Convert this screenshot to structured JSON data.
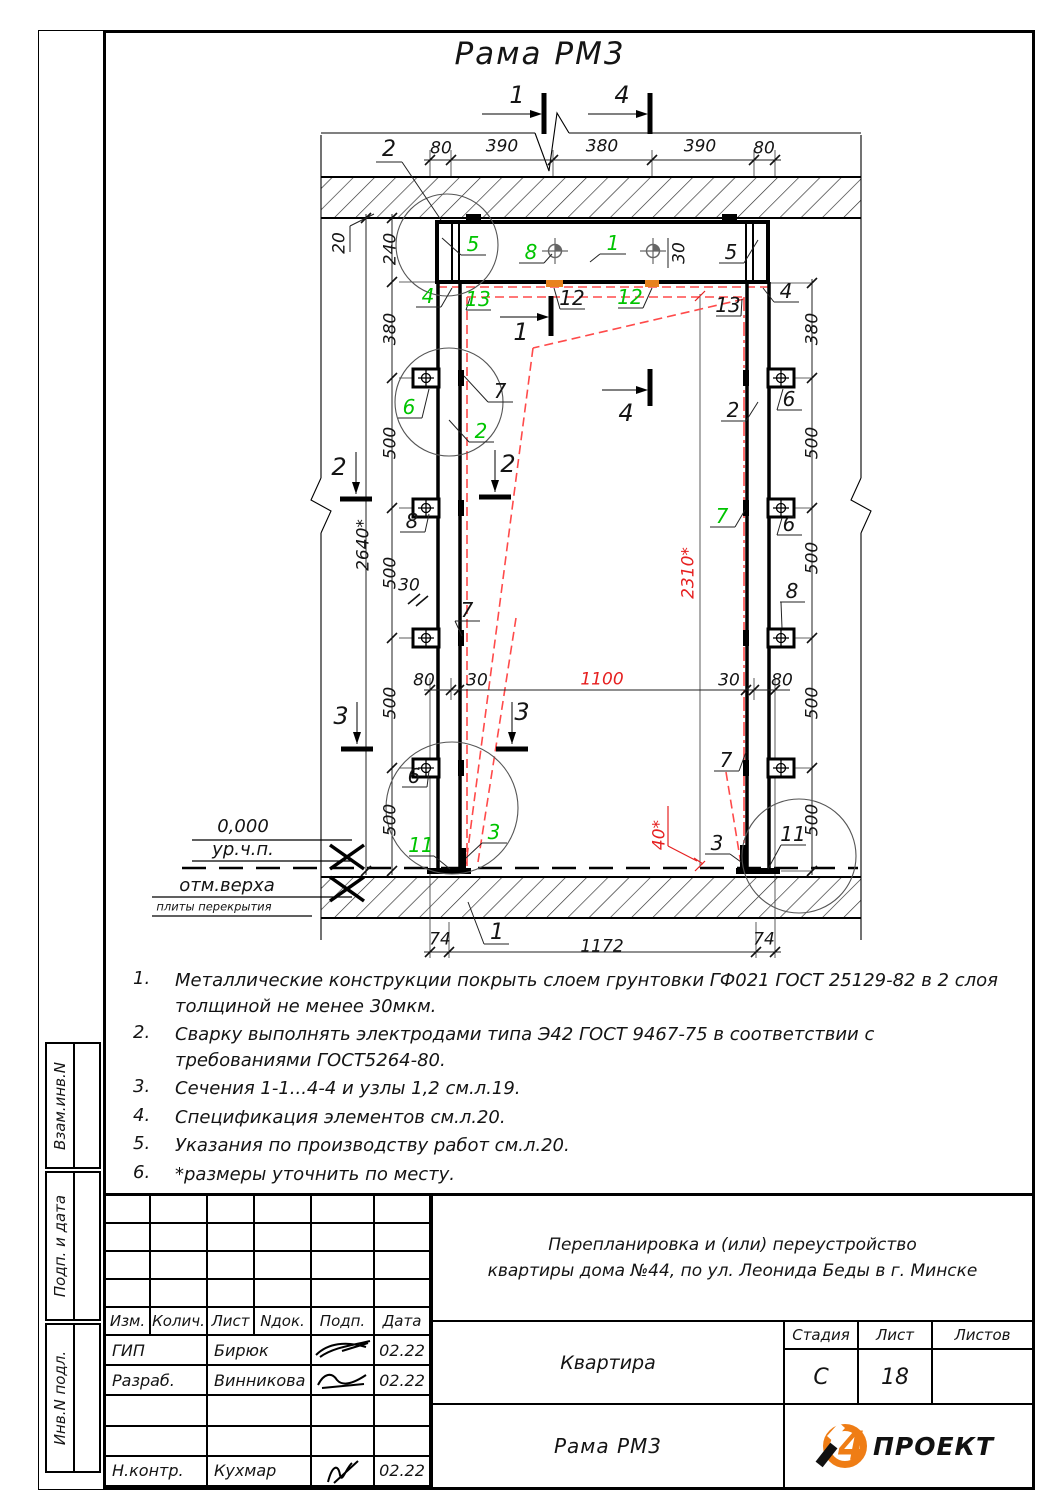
{
  "page": {
    "title": "Рама РМ3"
  },
  "colors": {
    "green": "#00c400",
    "red": "#e62020",
    "red_line": "#ff4a4a",
    "orange": "#e8821e"
  },
  "drawing": {
    "labels": [
      {
        "n": "dim-top-80-left",
        "t": "80",
        "x": 441,
        "y": 149
      },
      {
        "n": "dim-top-390-left",
        "t": "390",
        "x": 502,
        "y": 147
      },
      {
        "n": "dim-top-380",
        "t": "380",
        "x": 602,
        "y": 147
      },
      {
        "n": "dim-top-390-right",
        "t": "390",
        "x": 700,
        "y": 147
      },
      {
        "n": "dim-top-80-right",
        "t": "80",
        "x": 764,
        "y": 149
      },
      {
        "n": "dim-240-left",
        "t": "240",
        "x": 391,
        "y": 249,
        "r": -90
      },
      {
        "n": "dim-20-left",
        "t": "20",
        "x": 340,
        "y": 243,
        "r": -90
      },
      {
        "n": "dim-380-left",
        "t": "380",
        "x": 391,
        "y": 329,
        "r": -90
      },
      {
        "n": "dim-500-left-1",
        "t": "500",
        "x": 391,
        "y": 443,
        "r": -90
      },
      {
        "n": "dim-500-left-2",
        "t": "500",
        "x": 391,
        "y": 573,
        "r": -90
      },
      {
        "n": "dim-500-left-3",
        "t": "500",
        "x": 391,
        "y": 703,
        "r": -90
      },
      {
        "n": "dim-500-left-4",
        "t": "500",
        "x": 391,
        "y": 820,
        "r": -90
      },
      {
        "n": "dim-2640-left",
        "t": "2640*",
        "x": 364,
        "y": 545,
        "r": -90
      },
      {
        "n": "dim-380-right",
        "t": "380",
        "x": 813,
        "y": 329,
        "r": -90
      },
      {
        "n": "dim-500-right-1",
        "t": "500",
        "x": 813,
        "y": 443,
        "r": -90
      },
      {
        "n": "dim-500-right-2",
        "t": "500",
        "x": 813,
        "y": 558,
        "r": -90
      },
      {
        "n": "dim-500-right-3",
        "t": "500",
        "x": 813,
        "y": 703,
        "r": -90
      },
      {
        "n": "dim-500-right-4",
        "t": "500",
        "x": 813,
        "y": 820,
        "r": -90
      },
      {
        "n": "dim-2310-red",
        "t": "2310*",
        "x": 689,
        "y": 573,
        "r": -90,
        "c": "r"
      },
      {
        "n": "dim-40-red",
        "t": "40*",
        "x": 660,
        "y": 835,
        "r": -90,
        "c": "r"
      },
      {
        "n": "dim-1100-red",
        "t": "1100",
        "x": 602,
        "y": 680,
        "c": "r"
      },
      {
        "n": "dim-mid-80-left",
        "t": "80",
        "x": 424,
        "y": 681
      },
      {
        "n": "dim-mid-30-left",
        "t": "30",
        "x": 477,
        "y": 681
      },
      {
        "n": "dim-mid-30-right",
        "t": "30",
        "x": 729,
        "y": 681
      },
      {
        "n": "dim-mid-80-right",
        "t": "80",
        "x": 782,
        "y": 681
      },
      {
        "n": "dim-30-column",
        "t": "30",
        "x": 409,
        "y": 586
      },
      {
        "n": "dim-30-beam",
        "t": "30",
        "x": 680,
        "y": 253,
        "r": -90
      },
      {
        "n": "dim-74-left",
        "t": "74",
        "x": 440,
        "y": 940
      },
      {
        "n": "dim-1172-bottom",
        "t": "1172",
        "x": 602,
        "y": 947
      },
      {
        "n": "dim-74-right",
        "t": "74",
        "x": 764,
        "y": 940
      },
      {
        "n": "section-1-top",
        "t": "1",
        "x": 517,
        "y": 95,
        "s": 24
      },
      {
        "n": "section-4-top",
        "t": "4",
        "x": 622,
        "y": 95,
        "s": 24
      },
      {
        "n": "section-1-mid",
        "t": "1",
        "x": 521,
        "y": 332,
        "s": 24
      },
      {
        "n": "section-4-mid",
        "t": "4",
        "x": 626,
        "y": 413,
        "s": 24
      },
      {
        "n": "section-2-left",
        "t": "2",
        "x": 339,
        "y": 467,
        "s": 24
      },
      {
        "n": "section-2-mid",
        "t": "2",
        "x": 508,
        "y": 464,
        "s": 24
      },
      {
        "n": "section-3-left",
        "t": "3",
        "x": 341,
        "y": 716,
        "s": 24
      },
      {
        "n": "section-3-mid",
        "t": "3",
        "x": 522,
        "y": 712,
        "s": 24
      },
      {
        "n": "callout-2-top",
        "t": "2",
        "x": 389,
        "y": 150,
        "s": 22
      },
      {
        "n": "callout-5-left",
        "t": "5",
        "x": 473,
        "y": 244,
        "c": "g",
        "s": 20
      },
      {
        "n": "callout-8-bolt",
        "t": "8",
        "x": 531,
        "y": 252,
        "c": "g",
        "s": 20
      },
      {
        "n": "callout-1-beam",
        "t": "1",
        "x": 613,
        "y": 243,
        "c": "g",
        "s": 20
      },
      {
        "n": "callout-5-right",
        "t": "5",
        "x": 731,
        "y": 252,
        "s": 20
      },
      {
        "n": "callout-4-left",
        "t": "4",
        "x": 428,
        "y": 296,
        "c": "g",
        "s": 20
      },
      {
        "n": "callout-13-left",
        "t": "13",
        "x": 478,
        "y": 299,
        "c": "g",
        "s": 20
      },
      {
        "n": "callout-12-left",
        "t": "12",
        "x": 572,
        "y": 298,
        "s": 20
      },
      {
        "n": "callout-12-right",
        "t": "12",
        "x": 630,
        "y": 297,
        "c": "g",
        "s": 20
      },
      {
        "n": "callout-13-right",
        "t": "13",
        "x": 728,
        "y": 305,
        "s": 20
      },
      {
        "n": "callout-4-right",
        "t": "4",
        "x": 786,
        "y": 291,
        "s": 20
      },
      {
        "n": "callout-6-left-1",
        "t": "6",
        "x": 409,
        "y": 407,
        "c": "g",
        "s": 20
      },
      {
        "n": "callout-7-left-1",
        "t": "7",
        "x": 500,
        "y": 391,
        "s": 20
      },
      {
        "n": "callout-2-column",
        "t": "2",
        "x": 481,
        "y": 431,
        "c": "g",
        "s": 20
      },
      {
        "n": "callout-2-right",
        "t": "2",
        "x": 733,
        "y": 410,
        "s": 20
      },
      {
        "n": "callout-6-right-1",
        "t": "6",
        "x": 789,
        "y": 399,
        "s": 20
      },
      {
        "n": "callout-7-right",
        "t": "7",
        "x": 722,
        "y": 516,
        "c": "g",
        "s": 20
      },
      {
        "n": "callout-6-right-2",
        "t": "6",
        "x": 789,
        "y": 524,
        "s": 20
      },
      {
        "n": "callout-8-left",
        "t": "8",
        "x": 412,
        "y": 521,
        "s": 20
      },
      {
        "n": "callout-8-right",
        "t": "8",
        "x": 792,
        "y": 591,
        "s": 20
      },
      {
        "n": "callout-7-left-2",
        "t": "7",
        "x": 467,
        "y": 610,
        "s": 20
      },
      {
        "n": "callout-6-left-2",
        "t": "6",
        "x": 414,
        "y": 776,
        "s": 20
      },
      {
        "n": "callout-7-right-2",
        "t": "7",
        "x": 726,
        "y": 760,
        "s": 20
      },
      {
        "n": "callout-11-left",
        "t": "11",
        "x": 421,
        "y": 845,
        "c": "g",
        "s": 20
      },
      {
        "n": "callout-3-bottom",
        "t": "3",
        "x": 494,
        "y": 832,
        "c": "g",
        "s": 20
      },
      {
        "n": "callout-3-right",
        "t": "3",
        "x": 717,
        "y": 843,
        "s": 20
      },
      {
        "n": "callout-11-right",
        "t": "11",
        "x": 793,
        "y": 834,
        "s": 20
      },
      {
        "n": "callout-1-bottom",
        "t": "1",
        "x": 497,
        "y": 933,
        "s": 22
      },
      {
        "n": "elevation-value",
        "t": "0,000",
        "x": 243,
        "y": 827,
        "s": 18
      },
      {
        "n": "elevation-level-label",
        "t": "ур.ч.п.",
        "x": 243,
        "y": 850,
        "s": 18
      },
      {
        "n": "elevation-top-label",
        "t": "отм.верха",
        "x": 227,
        "y": 886,
        "s": 18
      },
      {
        "n": "elevation-top-sublabel",
        "t": "плиты перекрытия",
        "x": 214,
        "y": 907,
        "s": 11.5
      }
    ]
  },
  "notes": {
    "items": [
      {
        "num": "1.",
        "text": "Металлические конструкции покрыть слоем грунтовки ГФ021 ГОСТ 25129-82 в 2 слоя толщиной не менее 30мкм."
      },
      {
        "num": "2.",
        "text": "Сварку выполнять электродами типа Э42 ГОСТ 9467-75 в соответствии с требованиями ГОСТ5264-80."
      },
      {
        "num": "3.",
        "text": "Сечения 1-1...4-4 и узлы 1,2 см.л.19."
      },
      {
        "num": "4.",
        "text": "Спецификация элементов см.л.20."
      },
      {
        "num": "5.",
        "text": "Указания по производству работ см.л.20."
      },
      {
        "num": "6.",
        "text": "*размеры уточнить по месту."
      }
    ]
  },
  "titleblock": {
    "header_cols": [
      "Изм.",
      "Колич.",
      "Лист",
      "Nдок.",
      "Подп.",
      "Дата"
    ],
    "rows": [
      {
        "role": "ГИП",
        "name": "Бирюк",
        "date": "02.22"
      },
      {
        "role": "Разраб.",
        "name": "Винникова",
        "date": "02.22"
      },
      {
        "role": "",
        "name": "",
        "date": ""
      },
      {
        "role": "",
        "name": "",
        "date": ""
      },
      {
        "role": "Н.контр.",
        "name": "Кухмар",
        "date": "02.22"
      }
    ],
    "project_line1": "Перепланировка и (или) переустройство",
    "project_line2": "квартиры дома №44, по ул. Леонида Беды в г. Минске",
    "object_label": "Квартира",
    "sheet_name": "Рама РМ3",
    "stage_label": "Стадия",
    "stage_value": "С",
    "list_label": "Лист",
    "list_value": "18",
    "lists_label": "Листов",
    "lists_value": "",
    "logo": {
      "digit": "4",
      "text": "ПРОЕКТ"
    }
  },
  "sidebar": {
    "items": [
      {
        "label": "Взам.инв.N"
      },
      {
        "label": "Подп. и дата"
      },
      {
        "label": "Инв.N подл."
      }
    ]
  }
}
